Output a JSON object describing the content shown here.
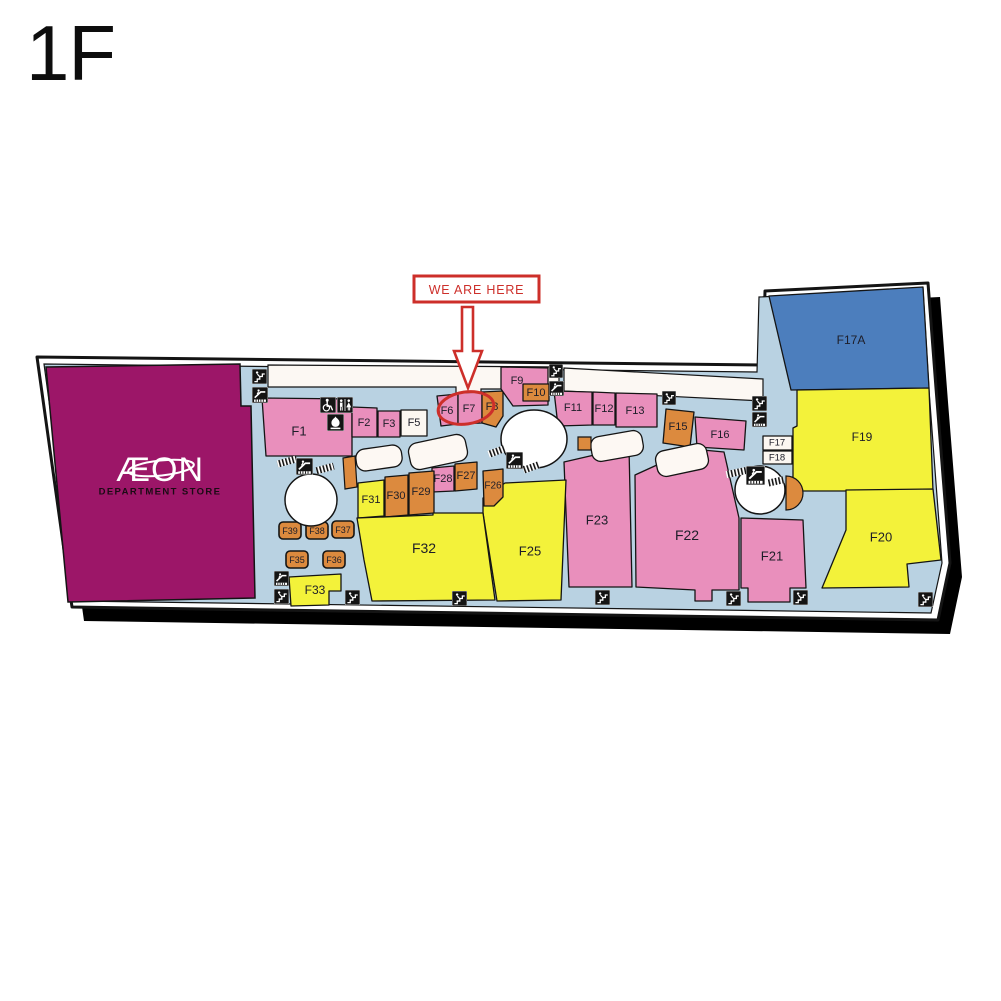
{
  "title": "1F",
  "aeon": {
    "logo": "ÆON",
    "subtitle": "DEPARTMENT STORE"
  },
  "marker": {
    "label": "WE ARE HERE",
    "target": "F7",
    "color": "#cd2f2a",
    "box": [
      414,
      276,
      125,
      26
    ],
    "arrow_points": "462,307 473,307 473,351 482,351 468,388 454,351 462,351",
    "ellipse": {
      "cx": 466,
      "cy": 408,
      "rx": 28,
      "ry": 16,
      "rot": -8
    }
  },
  "palette": {
    "pink": "#e98fbc",
    "orange": "#dc8a3e",
    "yellow": "#f3f23a",
    "blue": "#4c7ebd",
    "white_store": "#fcf7f1",
    "magenta": "#9c1668",
    "floor": "#b9d2e2",
    "outline": "#141414",
    "label": "#1d1d28"
  },
  "map": {
    "outline": "37,357 763,365 765,291 928,283 936,388 950,563 938,620 72,607",
    "floor": "44,364 757,372 759,297 923,289 929,390 942,563 931,613 76,601",
    "shadow_offset": [
      12,
      14
    ],
    "strips": [
      "268,365 559,367 559,389 481,389 481,395 456,395 456,387 268,387",
      "564,368 763,379 763,401 564,391"
    ],
    "islands": [
      {
        "cx": 379,
        "cy": 458,
        "w": 46,
        "h": 22,
        "r": -8
      },
      {
        "cx": 438,
        "cy": 452,
        "w": 58,
        "h": 27,
        "r": -12
      },
      {
        "cx": 617,
        "cy": 446,
        "w": 52,
        "h": 25,
        "r": -10
      },
      {
        "cx": 682,
        "cy": 460,
        "w": 52,
        "h": 26,
        "r": -12
      }
    ],
    "circles": [
      {
        "cx": 534,
        "cy": 439,
        "rx": 33,
        "ry": 29
      },
      {
        "cx": 311,
        "cy": 500,
        "rx": 26,
        "ry": 26
      },
      {
        "cx": 760,
        "cy": 490,
        "rx": 25,
        "ry": 24
      }
    ],
    "orange_shapes": [
      {
        "points": "343,458 355,456 357,487 345,489"
      },
      {
        "points": "578,437 591,437 591,450 578,450"
      }
    ],
    "half_disc": {
      "cx": 786,
      "cy": 493,
      "r": 17
    },
    "hatches": [
      {
        "x": 277,
        "y": 458,
        "w": 20,
        "h": 7,
        "r": -15
      },
      {
        "x": 316,
        "y": 465,
        "w": 18,
        "h": 7,
        "r": -15
      },
      {
        "x": 488,
        "y": 448,
        "w": 17,
        "h": 7,
        "r": -20
      },
      {
        "x": 523,
        "y": 464,
        "w": 16,
        "h": 7,
        "r": -20
      },
      {
        "x": 726,
        "y": 469,
        "w": 21,
        "h": 7,
        "r": -12
      },
      {
        "x": 767,
        "y": 478,
        "w": 17,
        "h": 7,
        "r": -12
      }
    ]
  },
  "aeon_store": {
    "points": "46,367 240,364 241,406 251,406 255,598 68,602",
    "logo_x": 160,
    "logo_y": 470,
    "sub_x": 160,
    "sub_y": 492
  },
  "stores": [
    {
      "id": "F1",
      "label": "F1",
      "color": "pink",
      "points": "262,398 352,399 352,456 266,456",
      "lx": 299,
      "ly": 431,
      "fs": 13
    },
    {
      "id": "F2",
      "label": "F2",
      "color": "pink",
      "points": "352,407 377,408 377,437 352,437",
      "lx": 364,
      "ly": 423,
      "fs": 11
    },
    {
      "id": "F3",
      "label": "F3",
      "color": "pink",
      "points": "378,411 400,411 400,437 378,437",
      "lx": 389,
      "ly": 424,
      "fs": 11
    },
    {
      "id": "F5",
      "label": "F5",
      "color": "white_store",
      "points": "401,410 427,410 427,436 401,436",
      "lx": 414,
      "ly": 423,
      "fs": 11
    },
    {
      "id": "F6",
      "label": "F6",
      "color": "pink",
      "points": "437,396 458,394 458,424 441,426",
      "lx": 447,
      "ly": 411,
      "fs": 11
    },
    {
      "id": "F7",
      "label": "F7",
      "color": "pink",
      "points": "458,393 482,392 482,423 458,424",
      "lx": 469,
      "ly": 409,
      "fs": 11
    },
    {
      "id": "F8",
      "label": "F8",
      "color": "orange",
      "points": "482,392 503,391 503,416 496,427 482,423",
      "lx": 492,
      "ly": 407,
      "fs": 11
    },
    {
      "id": "F9",
      "label": "F9",
      "color": "pink",
      "points": "501,367 548,368 548,405 513,406 501,389",
      "lx": 517,
      "ly": 381,
      "fs": 11
    },
    {
      "id": "F10",
      "label": "F10",
      "color": "orange",
      "points": "523,384 549,384 549,401 523,401",
      "lx": 536,
      "ly": 393,
      "fs": 11
    },
    {
      "id": "F11",
      "label": "F11",
      "color": "pink",
      "points": "554,391 592,392 592,425 558,426",
      "lx": 573,
      "ly": 408,
      "fs": 11
    },
    {
      "id": "F12",
      "label": "F12",
      "color": "pink",
      "points": "593,392 615,393 615,425 593,425",
      "lx": 604,
      "ly": 409,
      "fs": 11
    },
    {
      "id": "F13",
      "label": "F13",
      "color": "pink",
      "points": "616,393 657,394 657,427 616,427",
      "lx": 635,
      "ly": 411,
      "fs": 11
    },
    {
      "id": "F15",
      "label": "F15",
      "color": "orange",
      "points": "666,409 694,412 690,447 663,443",
      "lx": 678,
      "ly": 427,
      "fs": 11
    },
    {
      "id": "F16",
      "label": "F16",
      "color": "pink",
      "points": "695,417 746,421 744,450 697,447",
      "lx": 720,
      "ly": 435,
      "fs": 11
    },
    {
      "id": "F17",
      "label": "F17",
      "color": "white_store",
      "points": "763,436 792,436 792,450 763,450",
      "lx": 777,
      "ly": 443,
      "fs": 9.5
    },
    {
      "id": "F18",
      "label": "F18",
      "color": "white_store",
      "points": "763,451 792,451 792,464 763,464",
      "lx": 777,
      "ly": 458,
      "fs": 9.5
    },
    {
      "id": "F17A",
      "label": "F17A",
      "color": "blue",
      "points": "769,296 923,287 929,388 791,390",
      "lx": 851,
      "ly": 340,
      "fs": 12
    },
    {
      "id": "F19",
      "label": "F19",
      "color": "yellow",
      "points": "797,390 929,388 933,491 793,491 793,428 797,426",
      "lx": 862,
      "ly": 437,
      "fs": 12
    },
    {
      "id": "F20",
      "label": "F20",
      "color": "yellow",
      "points": "846,490 933,489 941,560 907,564 909,587 822,588 846,530",
      "lx": 881,
      "ly": 537,
      "fs": 13
    },
    {
      "id": "F21",
      "label": "F21",
      "color": "pink",
      "points": "741,518 803,520 806,588 790,588 790,602 748,602 748,588 741,588",
      "lx": 772,
      "ly": 556,
      "fs": 13
    },
    {
      "id": "F22",
      "label": "F22",
      "color": "pink",
      "points": "635,475 692,449 724,452 739,518 739,590 712,590 712,601 695,601 695,590 636,587",
      "lx": 687,
      "ly": 535,
      "fs": 14
    },
    {
      "id": "F23",
      "label": "F23",
      "color": "pink",
      "points": "564,462 629,447 632,587 569,587",
      "lx": 597,
      "ly": 520,
      "fs": 13
    },
    {
      "id": "F25",
      "label": "F25",
      "color": "yellow",
      "points": "483,513 483,498 505,483 566,480 561,600 497,601",
      "lx": 530,
      "ly": 551,
      "fs": 13
    },
    {
      "id": "F26",
      "label": "F26",
      "color": "orange",
      "points": "483,471 503,469 503,497 494,506 484,506",
      "lx": 493,
      "ly": 486,
      "fs": 10
    },
    {
      "id": "F27",
      "label": "F27",
      "color": "orange",
      "points": "455,464 477,462 477,489 455,491",
      "lx": 466,
      "ly": 476,
      "fs": 11
    },
    {
      "id": "F28",
      "label": "F28",
      "color": "pink",
      "points": "432,468 454,466 454,491 432,492",
      "lx": 443,
      "ly": 479,
      "fs": 11
    },
    {
      "id": "F29",
      "label": "F29",
      "color": "orange",
      "points": "409,473 434,471 434,513 409,515",
      "lx": 421,
      "ly": 492,
      "fs": 11
    },
    {
      "id": "F30",
      "label": "F30",
      "color": "orange",
      "points": "385,477 408,475 408,515 385,517",
      "lx": 396,
      "ly": 496,
      "fs": 11
    },
    {
      "id": "F31",
      "label": "F31",
      "color": "yellow",
      "points": "358,483 384,480 384,516 358,518",
      "lx": 371,
      "ly": 500,
      "fs": 11
    },
    {
      "id": "F32",
      "label": "F32",
      "color": "yellow",
      "points": "357,518 433,515 433,513 483,513 495,600 372,601 364,560",
      "lx": 424,
      "ly": 548,
      "fs": 14
    },
    {
      "id": "F33",
      "label": "F33",
      "color": "yellow",
      "points": "289,577 341,574 341,591 329,591 329,605 291,606",
      "lx": 315,
      "ly": 590,
      "fs": 12
    },
    {
      "id": "F39",
      "label": "F39",
      "color": "orange",
      "rect": [
        279,
        522,
        22,
        17
      ],
      "rx": 4,
      "lx": 290,
      "ly": 531,
      "fs": 9
    },
    {
      "id": "F38",
      "label": "F38",
      "color": "orange",
      "rect": [
        306,
        522,
        22,
        17
      ],
      "rx": 4,
      "lx": 317,
      "ly": 531,
      "fs": 9
    },
    {
      "id": "F37",
      "label": "F37",
      "color": "orange",
      "rect": [
        332,
        521,
        22,
        17
      ],
      "rx": 4,
      "lx": 343,
      "ly": 530,
      "fs": 9
    },
    {
      "id": "F35",
      "label": "F35",
      "color": "orange",
      "rect": [
        286,
        551,
        22,
        17
      ],
      "rx": 4,
      "lx": 297,
      "ly": 560,
      "fs": 9
    },
    {
      "id": "F36",
      "label": "F36",
      "color": "orange",
      "rect": [
        323,
        551,
        22,
        17
      ],
      "rx": 4,
      "lx": 334,
      "ly": 560,
      "fs": 9
    }
  ],
  "icons": [
    {
      "t": "stairs",
      "x": 252,
      "y": 369,
      "s": 15
    },
    {
      "t": "escalator",
      "x": 252,
      "y": 387,
      "s": 16
    },
    {
      "t": "wheelchair",
      "x": 320,
      "y": 397,
      "s": 16
    },
    {
      "t": "restroom",
      "x": 337,
      "y": 397,
      "s": 16
    },
    {
      "t": "prayer",
      "x": 327,
      "y": 414,
      "s": 17
    },
    {
      "t": "stairs",
      "x": 549,
      "y": 364,
      "s": 14
    },
    {
      "t": "escalator",
      "x": 549,
      "y": 381,
      "s": 15
    },
    {
      "t": "stairs",
      "x": 662,
      "y": 391,
      "s": 14
    },
    {
      "t": "stairs",
      "x": 752,
      "y": 396,
      "s": 15
    },
    {
      "t": "escalator",
      "x": 752,
      "y": 412,
      "s": 15
    },
    {
      "t": "escalator",
      "x": 506,
      "y": 452,
      "s": 17
    },
    {
      "t": "escalator",
      "x": 296,
      "y": 458,
      "s": 17
    },
    {
      "t": "escalator",
      "x": 746,
      "y": 466,
      "s": 19
    },
    {
      "t": "escalator",
      "x": 274,
      "y": 571,
      "s": 15
    },
    {
      "t": "stairs",
      "x": 274,
      "y": 589,
      "s": 15
    },
    {
      "t": "stairs",
      "x": 345,
      "y": 590,
      "s": 15
    },
    {
      "t": "stairs",
      "x": 452,
      "y": 591,
      "s": 15
    },
    {
      "t": "stairs",
      "x": 595,
      "y": 590,
      "s": 15
    },
    {
      "t": "stairs",
      "x": 726,
      "y": 591,
      "s": 15
    },
    {
      "t": "stairs",
      "x": 793,
      "y": 590,
      "s": 15
    },
    {
      "t": "stairs",
      "x": 918,
      "y": 592,
      "s": 15
    }
  ]
}
